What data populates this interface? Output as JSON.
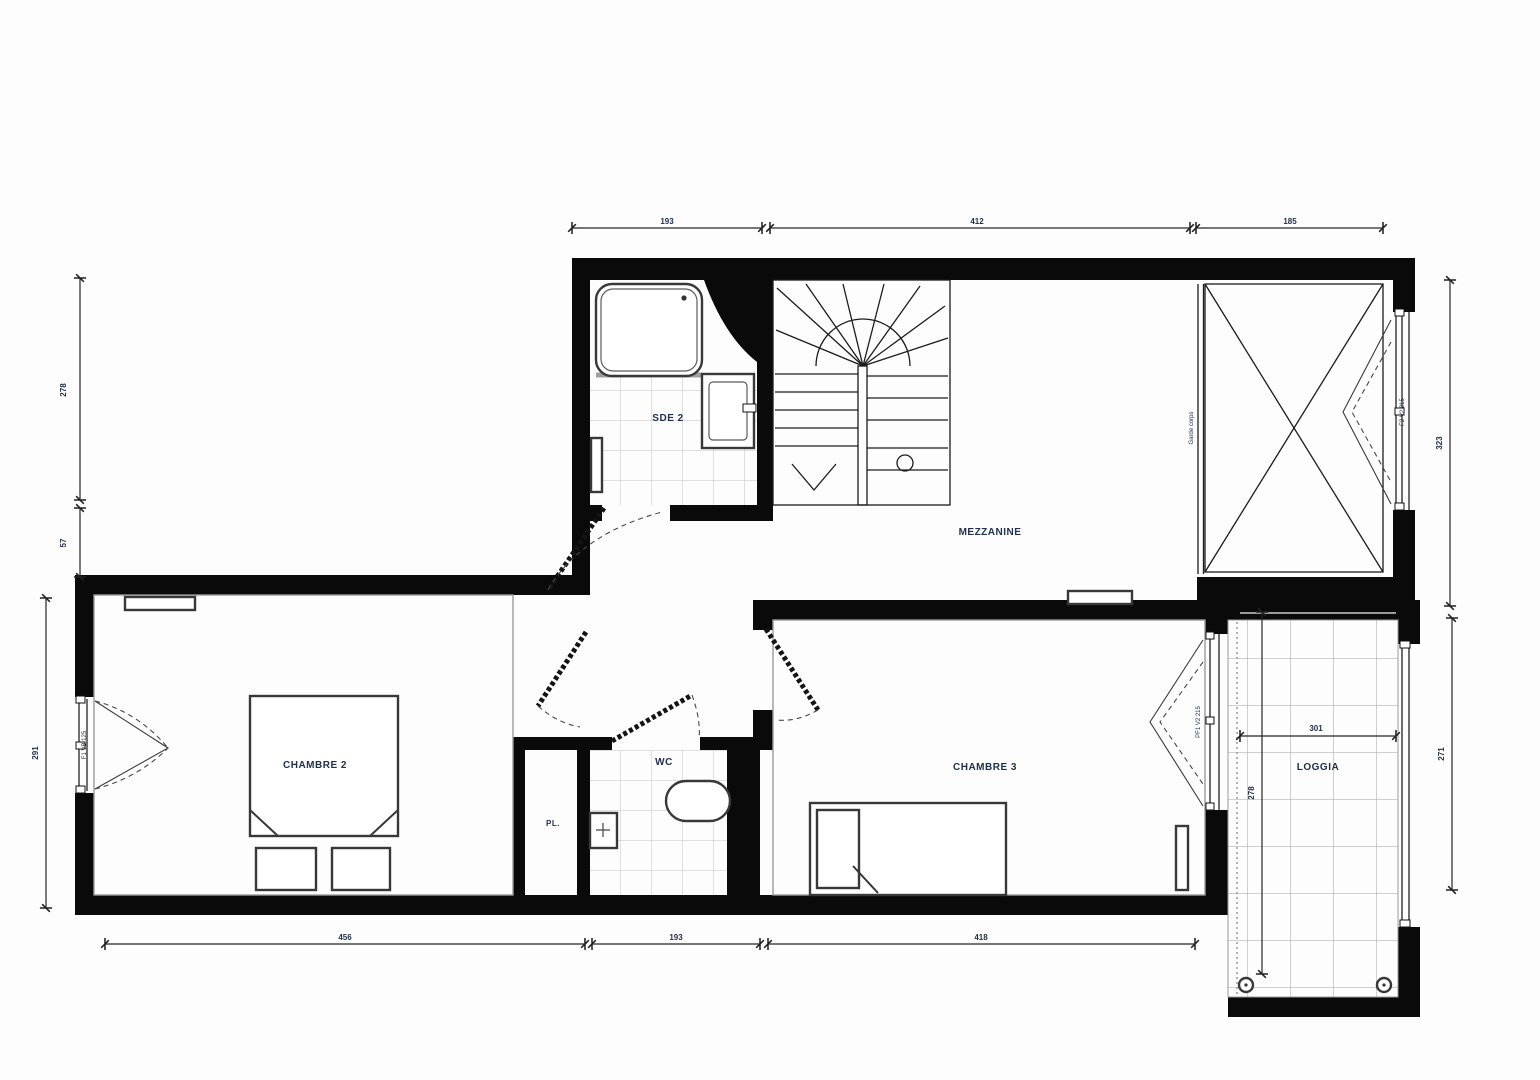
{
  "colors": {
    "wall": "#0a0a0a",
    "label": "#21304e",
    "dim": "#23304d",
    "tile": "#c2c2c2"
  },
  "rooms": {
    "sde2": {
      "label": "SDE 2"
    },
    "mezzanine": {
      "label": "MEZZANINE"
    },
    "chambre2": {
      "label": "CHAMBRE 2"
    },
    "chambre3": {
      "label": "CHAMBRE 3"
    },
    "wc": {
      "label": "WC"
    },
    "pl": {
      "label": "PL."
    },
    "loggia": {
      "label": "LOGGIA"
    }
  },
  "dimensions": {
    "top_left": "193",
    "top_middle": "412",
    "top_right": "185",
    "bottom_left": "456",
    "bottom_middle": "193",
    "bottom_right": "418",
    "left_upper": "278",
    "left_small": "57",
    "left_lower": "291",
    "right_upper": "323",
    "loggia_right": "271",
    "loggia_width": "301",
    "loggia_height": "278"
  },
  "annotations": {
    "guardrail": "Garde corps",
    "window_upper_right": "F2 V2 215",
    "window_chambre2": "F1 VB 125",
    "door_loggia": "PF1 V2 215"
  }
}
